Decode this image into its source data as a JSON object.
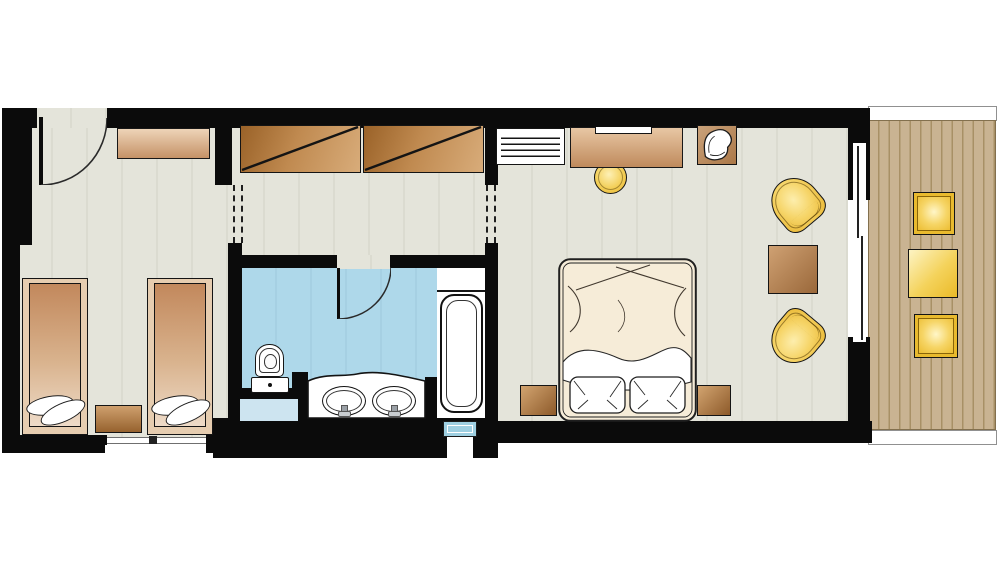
{
  "diagram": {
    "type": "floor-plan",
    "subject": "hotel-suite-top-view-floor-plan",
    "palette": {
      "wall": "#0b0b0b",
      "canvas": "#ffffff",
      "room_floor": "#e3e3d9",
      "room_floor_stripe": "#dbdbd0",
      "bath_floor": "#abd6e8",
      "bath_niche": "#cde4f0",
      "glass_blue": "#9fd0e2",
      "wood_light": "#ecd2b5",
      "wood_mid": "#c79468",
      "wood_dark": "#9c6630",
      "bed_linen": "#f6ecd8",
      "pillow": "#ffffff",
      "accent_yellow": "#f0c23c",
      "accent_yellow_light": "#fdeead",
      "deck_wood": "#c9b392",
      "deck_line": "#a28b66",
      "railing": "#ffffff",
      "outline": "#1a1a1a"
    },
    "rooms": [
      {
        "id": "twin-bedroom",
        "furniture": [
          "entrance-door",
          "dresser",
          "single-bed",
          "single-bed",
          "nightstand",
          "window"
        ]
      },
      {
        "id": "hallway",
        "furniture": [
          "wardrobe",
          "wardrobe",
          "open-passage-left",
          "open-passage-right"
        ]
      },
      {
        "id": "bathroom",
        "furniture": [
          "door",
          "toilet",
          "double-vanity",
          "sink",
          "sink",
          "bathtub",
          "window",
          "niche"
        ]
      },
      {
        "id": "master-bedroom",
        "furniture": [
          "radiator-shelf",
          "desk",
          "stool",
          "armchair",
          "double-bed",
          "pillow",
          "pillow",
          "nightstand",
          "nightstand",
          "lounge-chair",
          "lounge-chair",
          "coffee-table",
          "sliding-glass-door"
        ]
      },
      {
        "id": "balcony",
        "furniture": [
          "wood-deck",
          "railing",
          "outdoor-chair",
          "outdoor-table",
          "outdoor-chair"
        ]
      }
    ]
  }
}
